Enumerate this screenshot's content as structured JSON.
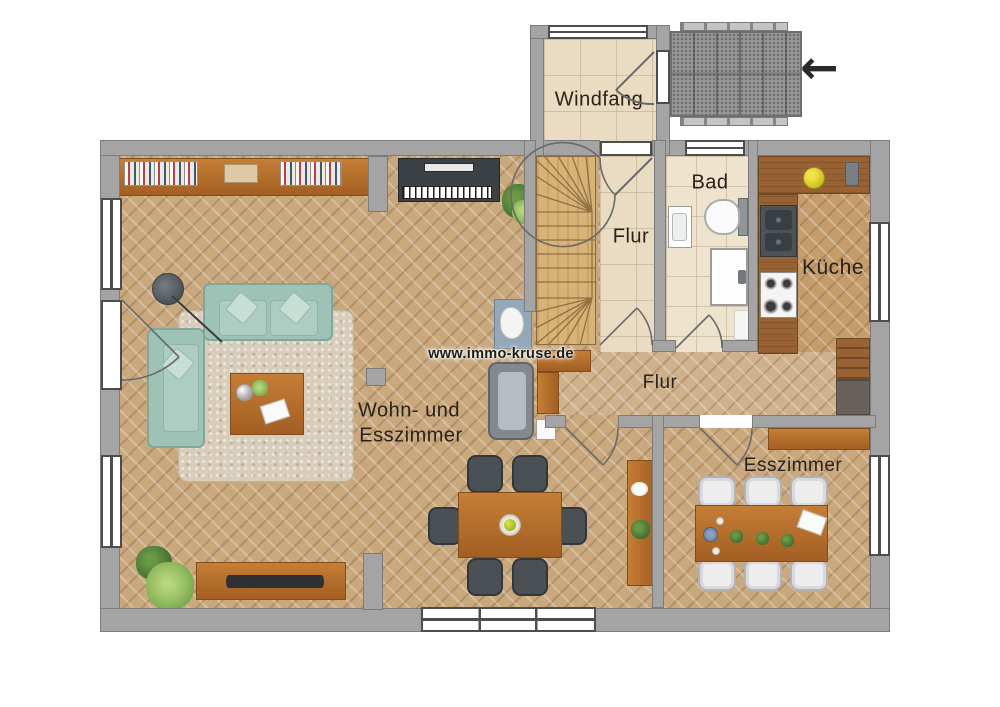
{
  "watermark": "www.immo-kruse.de",
  "rooms": {
    "windfang": "Windfang",
    "bad": "Bad",
    "flur_upper": "Flur",
    "kueche": "Küche",
    "flur_lower": "Flur",
    "wohn_esszimmer_1": "Wohn- und",
    "wohn_esszimmer_2": "Esszimmer",
    "esszimmer": "Esszimmer"
  },
  "entry_arrow": "←",
  "colors": {
    "wall": "#a4a4a4",
    "wall_edge": "#7b7b7b",
    "wood_floor": "#c9a87e",
    "wood_floor_light": "#cfb28c",
    "tile_floor": "#e9dcc2",
    "sofa_teal": "#9fc2b6",
    "label_text": "#2a211a",
    "porch": "#979797"
  }
}
